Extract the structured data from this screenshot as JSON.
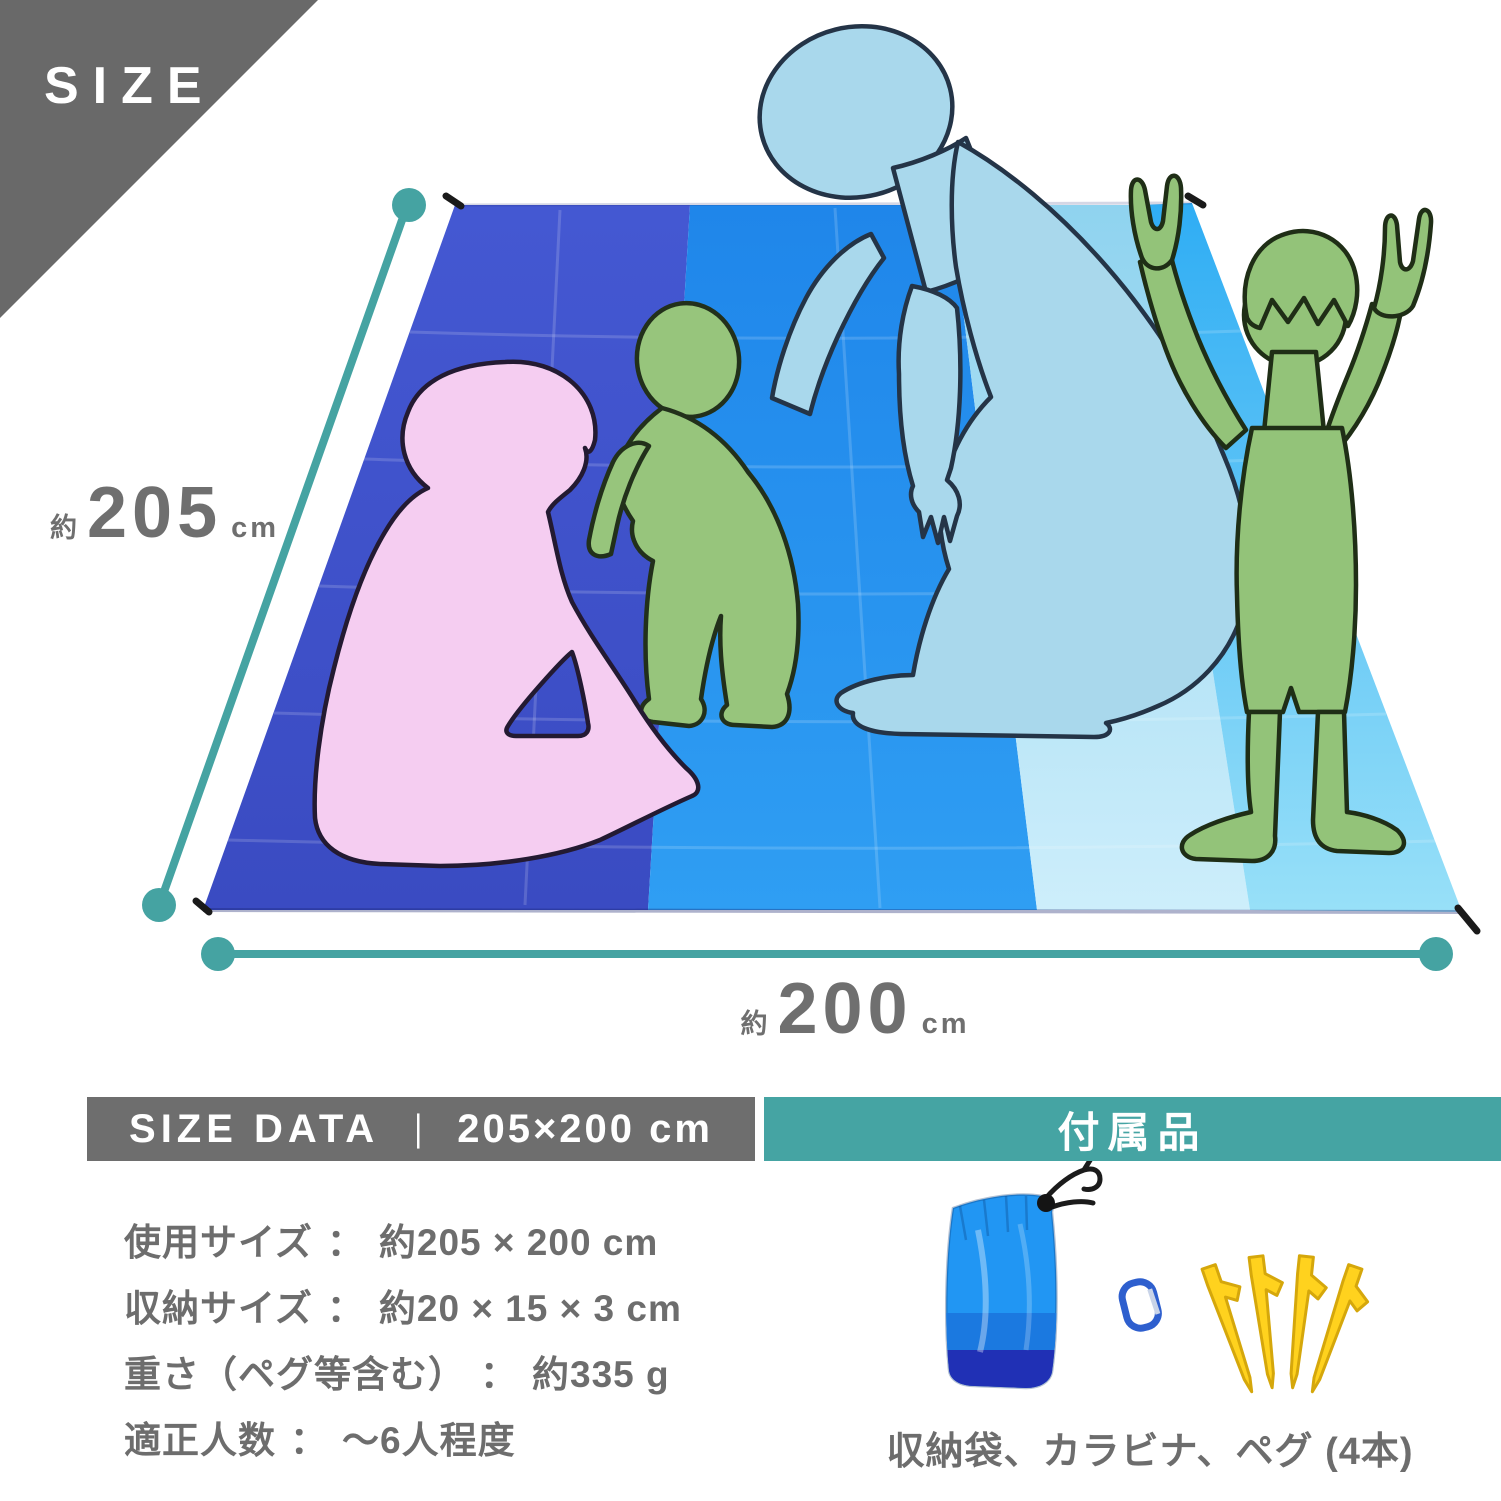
{
  "badge": {
    "label": "SIZE"
  },
  "dimensions": {
    "height": {
      "approx": "約",
      "value": "205",
      "unit": "cm"
    },
    "width": {
      "approx": "約",
      "value": "200",
      "unit": "cm"
    }
  },
  "size_data_bar": {
    "title": "SIZE DATA",
    "separator": "｜",
    "value": "205×200 cm"
  },
  "accessories_bar": {
    "title": "付属品"
  },
  "specs": {
    "rows": [
      {
        "label": "使用サイズ",
        "sep": "：",
        "value": "約205 × 200 cm"
      },
      {
        "label": "収納サイズ",
        "sep": "：",
        "value": "約20 × 15 × 3 cm"
      },
      {
        "label": "重さ（ペグ等含む）",
        "sep": "：",
        "value": "約335 g"
      },
      {
        "label": "適正人数",
        "sep": "：",
        "value": "～6人程度"
      }
    ]
  },
  "accessories": {
    "caption": "収納袋、カラビナ、ペグ (4本)"
  },
  "illustration": {
    "figures": [
      "seated-woman-silhouette",
      "toddler-silhouette",
      "bending-adult-silhouette",
      "cheering-child-silhouette"
    ],
    "blanket_panels": 4
  },
  "colors": {
    "accent_teal": "#45a3a2",
    "header_gray": "#6e6e6e",
    "text_gray": "#6d6d6d",
    "band_indigo": "#3f50c7",
    "band_azure": "#2490ef",
    "band_pale_cyan": "#c4ecfb",
    "band_sky_cyan": "#5cc6f2",
    "silhouette_pink": "#f5cdf1",
    "silhouette_green": "#93c379",
    "silhouette_lightblue": "#a9d8ec",
    "bag_blue": "#2196f3",
    "bag_navy": "#2030b5",
    "peg_yellow": "#ffd21e",
    "carabiner_blue": "#2e5fce"
  }
}
